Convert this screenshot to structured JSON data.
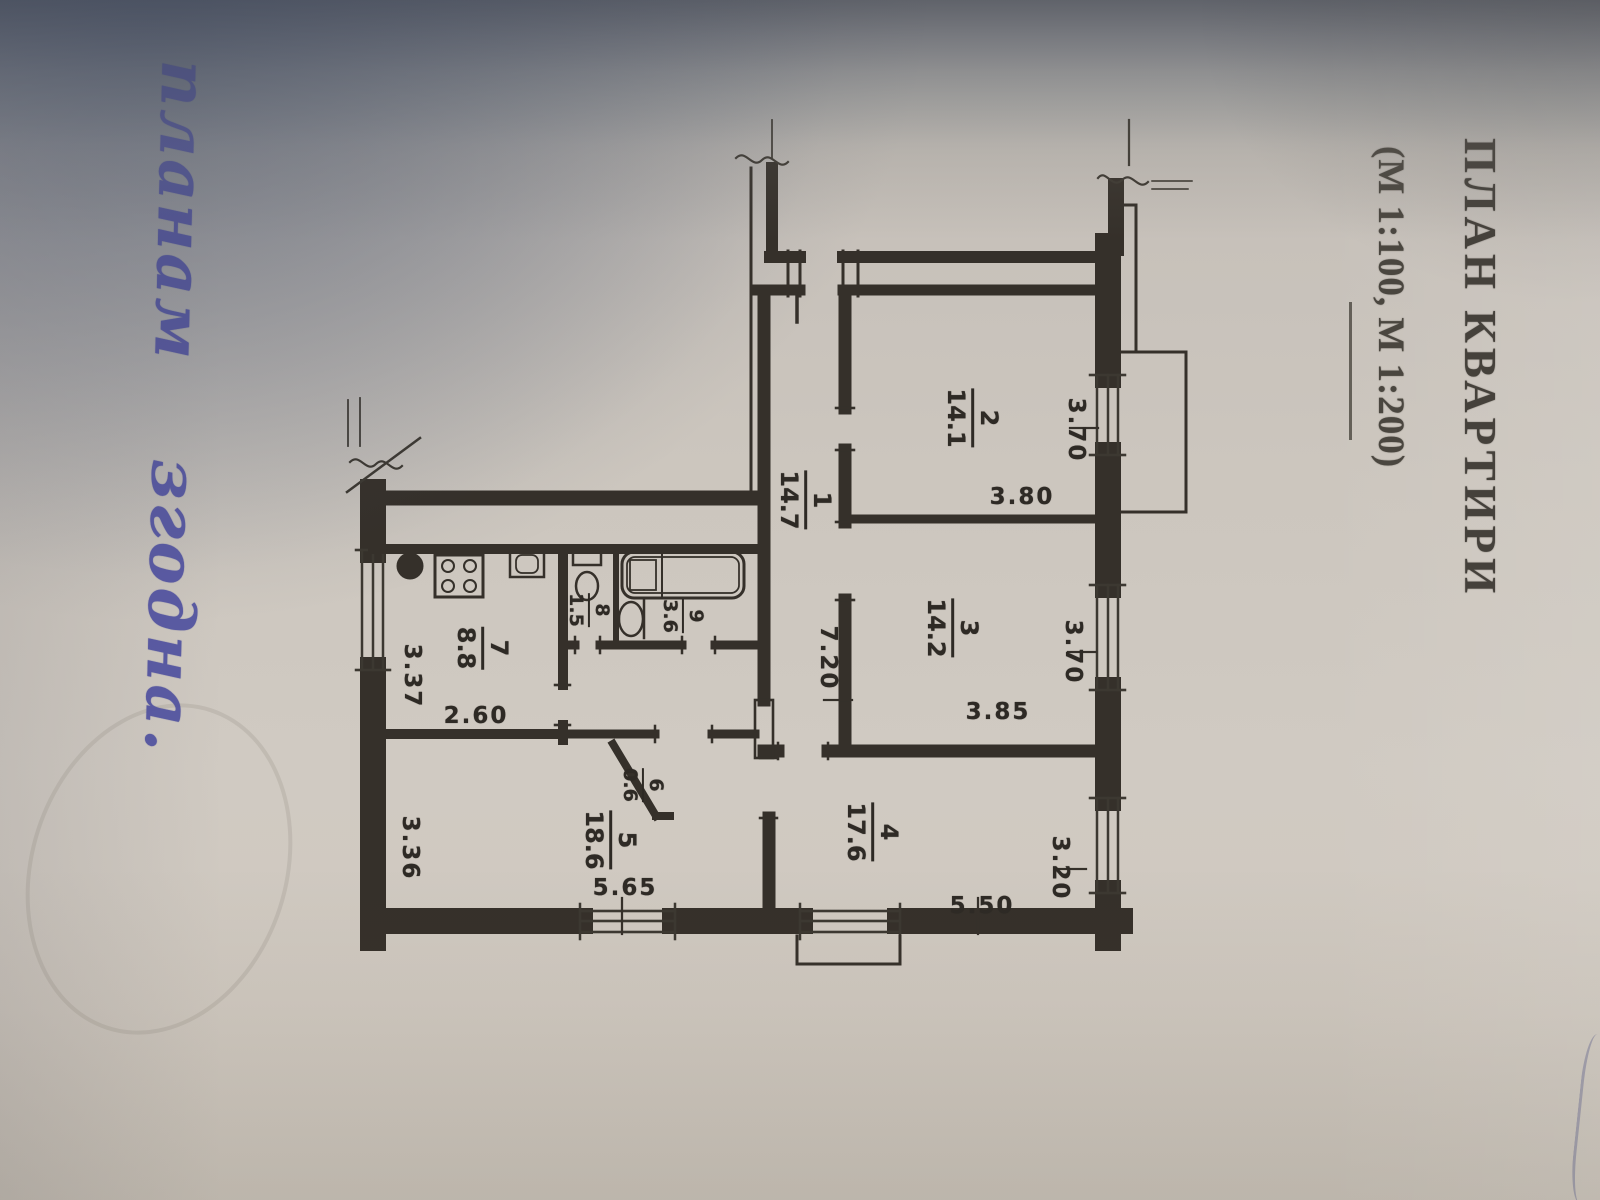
{
  "document": {
    "title": "ПЛАН КВАРТИРИ",
    "scale_note": "(М 1:100, М 1:200)",
    "handwriting": "планам згодна."
  },
  "plan": {
    "rooms": [
      {
        "num": "1",
        "area": "14.7"
      },
      {
        "num": "2",
        "area": "14.1"
      },
      {
        "num": "3",
        "area": "14.2"
      },
      {
        "num": "4",
        "area": "17.6"
      },
      {
        "num": "5",
        "area": "18.6"
      },
      {
        "num": "6",
        "area": "0.6"
      },
      {
        "num": "7",
        "area": "8.8"
      },
      {
        "num": "8",
        "area": "1.5"
      },
      {
        "num": "9",
        "area": "3.6"
      }
    ],
    "dimensions": {
      "corridor_len": "7.20",
      "room2_w": "3.70",
      "room2_d": "3.80",
      "room3_w": "3.70",
      "room3_d": "3.85",
      "room4_w": "3.20",
      "room4_d": "5.50",
      "room5_w": "3.36",
      "room5_d": "5.65",
      "kitchen_w": "3.37",
      "kitchen_d": "2.60"
    }
  },
  "colors": {
    "paper": "#cdc7bf",
    "ink": "#36322c",
    "pen": "#50519f"
  }
}
